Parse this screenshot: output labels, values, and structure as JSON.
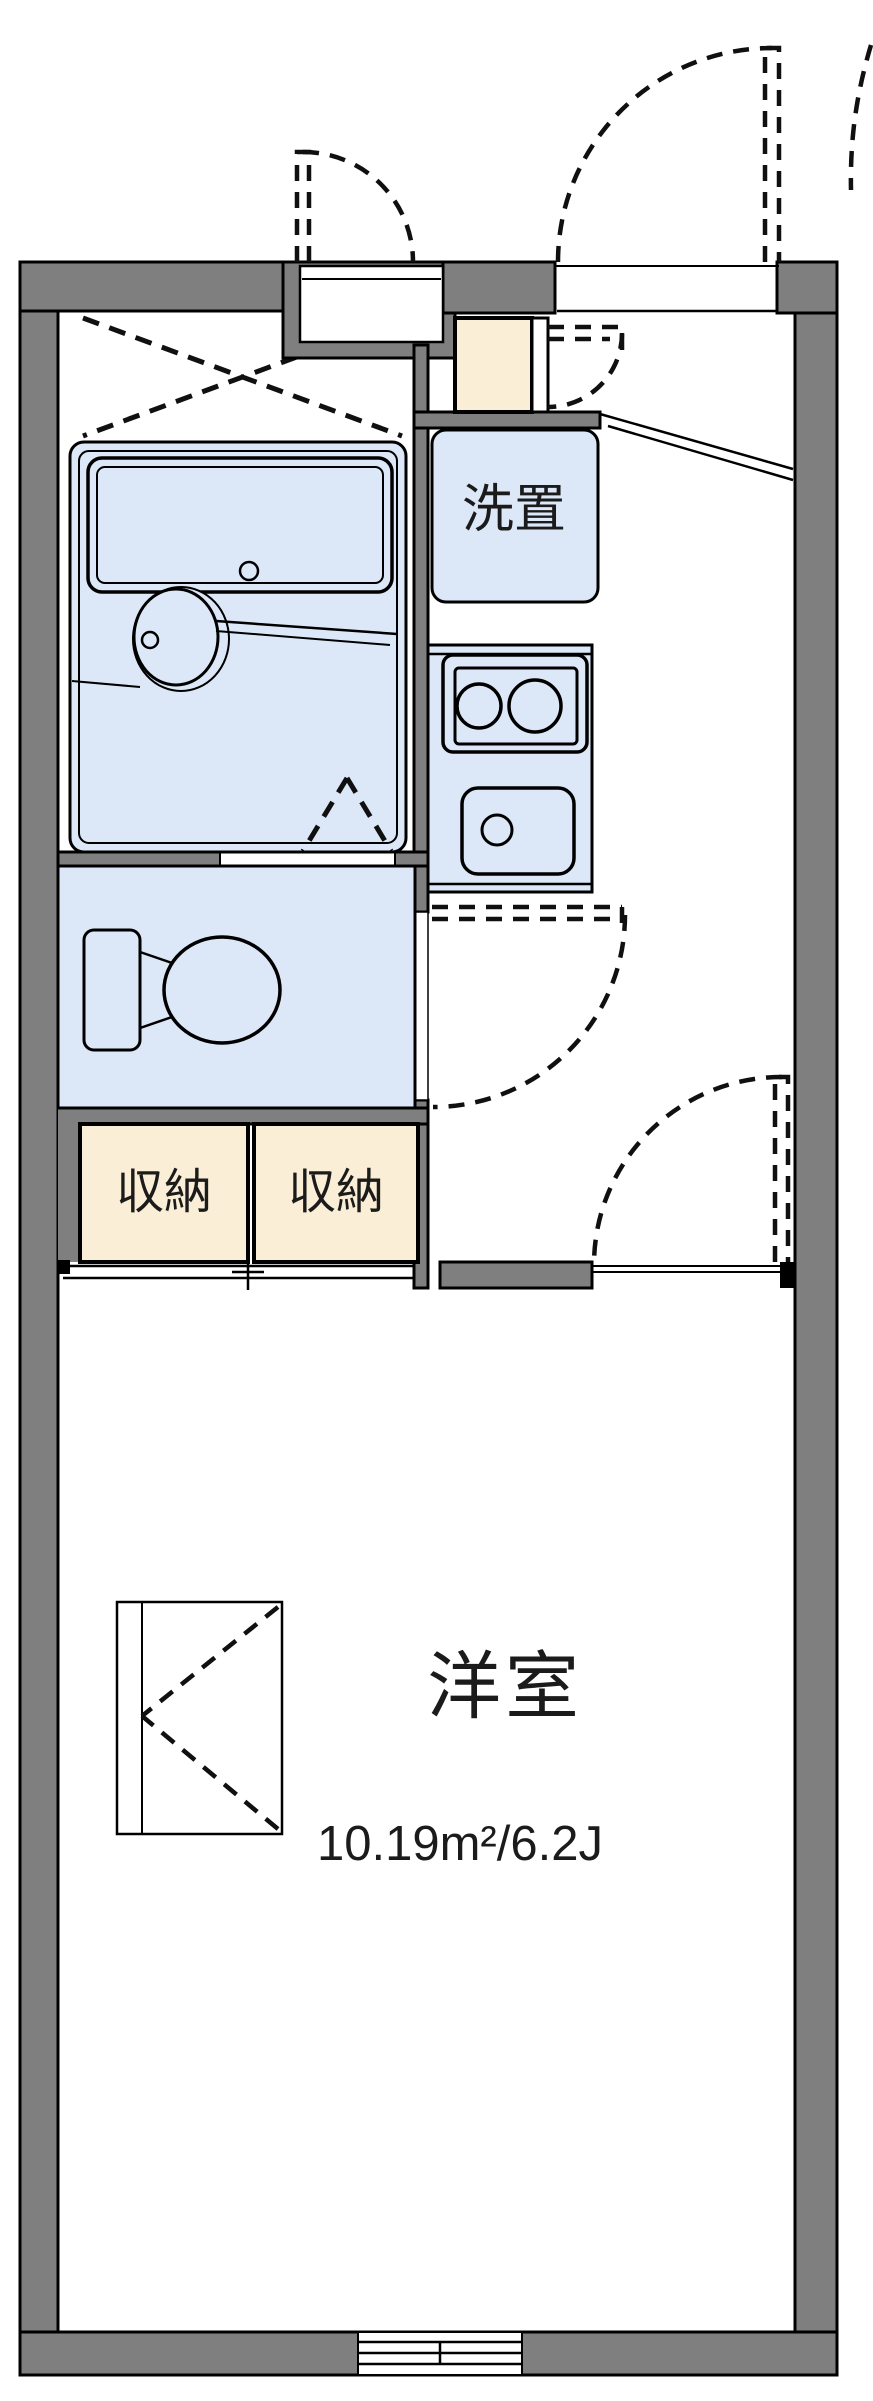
{
  "floor_plan": {
    "type": "japanese-apartment-floor-plan",
    "labels": {
      "washer": "洗置",
      "storage_left": "収納",
      "storage_right": "収納",
      "room_name": "洋室",
      "room_area": "10.19m²/6.2J"
    },
    "colors": {
      "wall": "#7f7f7f",
      "fixture_fill": "#dce7f7",
      "storage_fill": "#fbeed6",
      "line": "#111111",
      "background": "#ffffff"
    }
  }
}
